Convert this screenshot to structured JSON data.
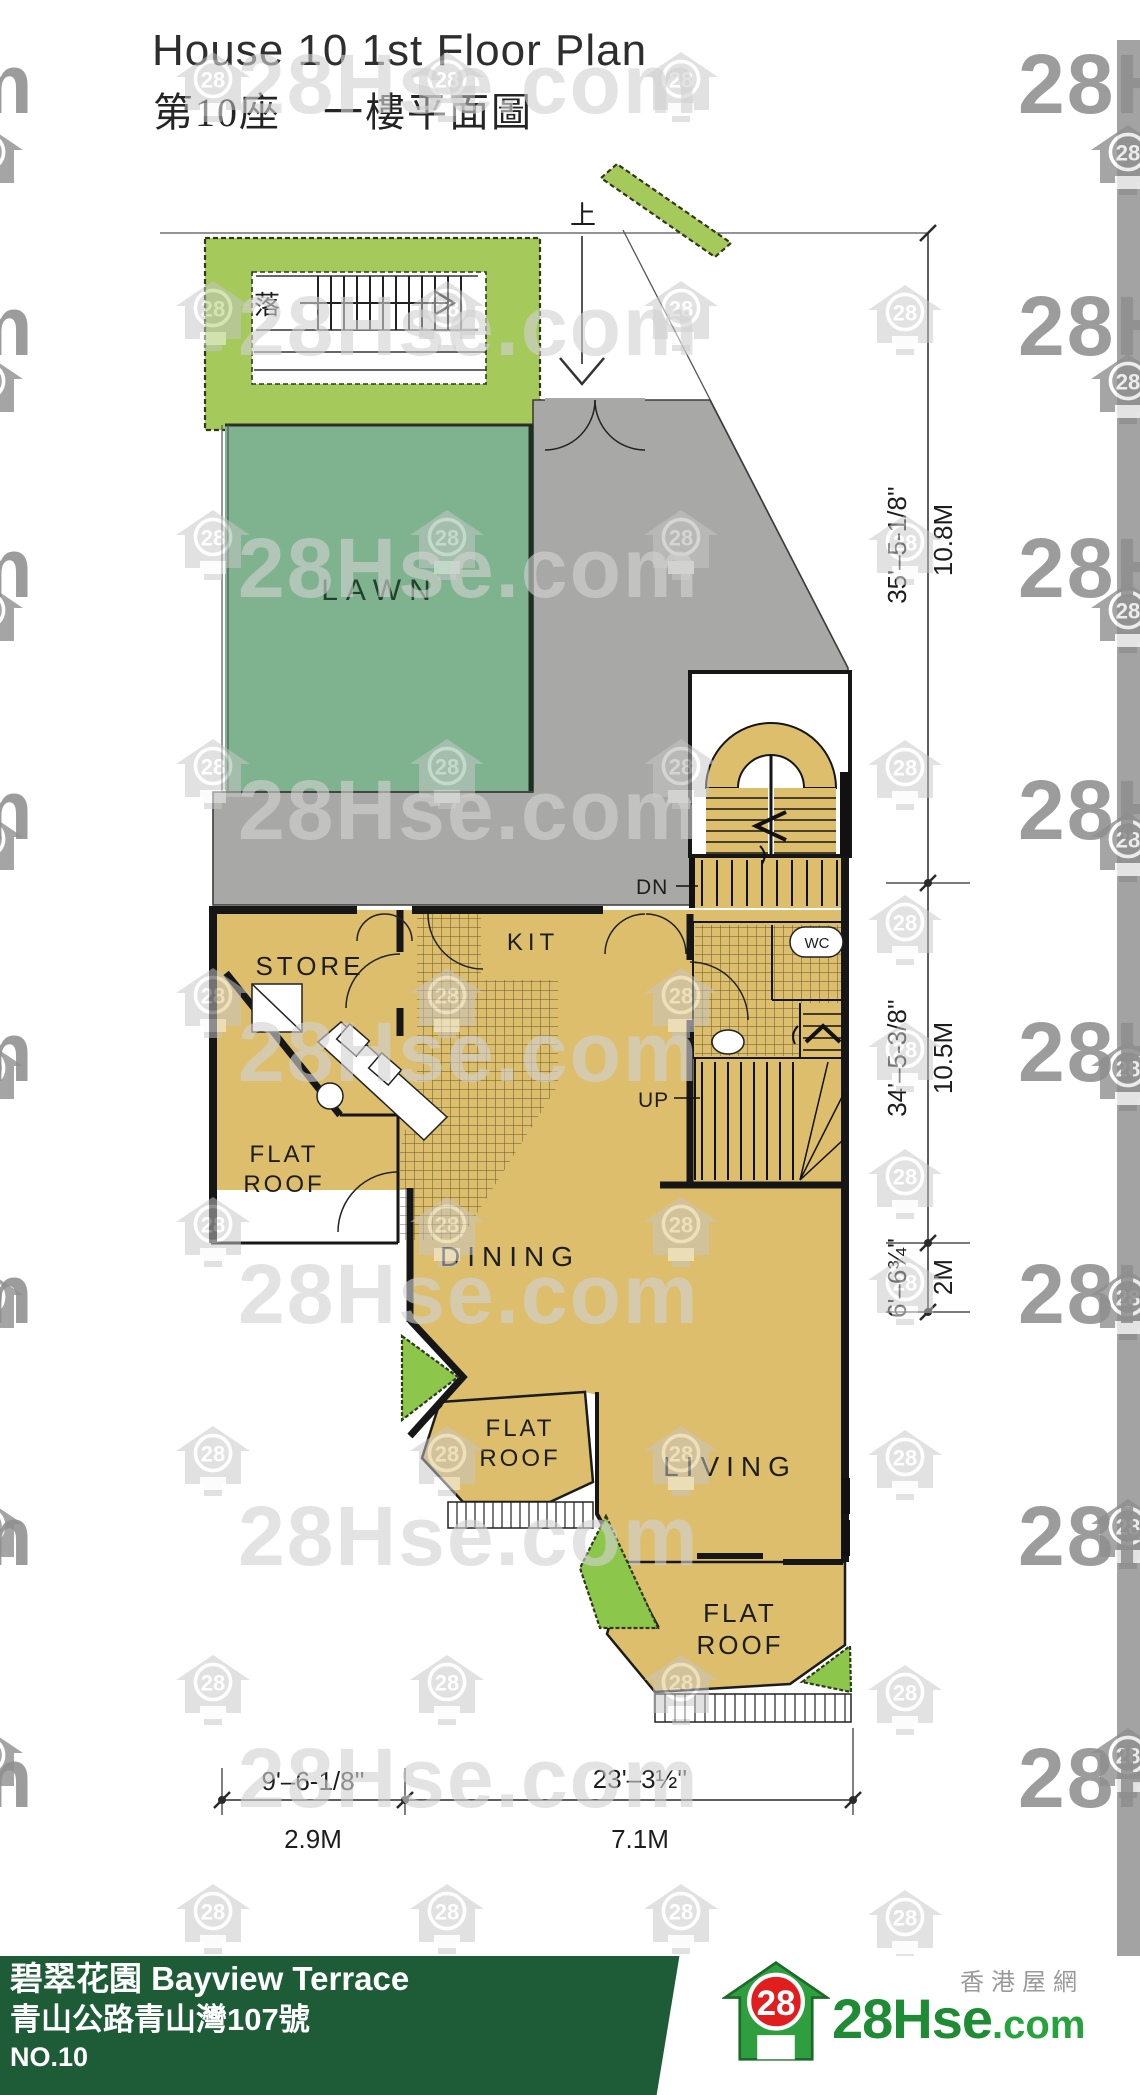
{
  "header": {
    "title_en": "House 10 1st Floor Plan",
    "title_zh": "第10座　一樓平面圖"
  },
  "plan": {
    "north_label": "上",
    "descend_label": "落",
    "rooms": {
      "lawn": "LAWN",
      "store": "STORE",
      "kitchen": "KIT",
      "wc": "WC",
      "dining": "DINING",
      "living": "LIVING",
      "flat": "FLAT",
      "roof": "ROOF"
    },
    "stairs": {
      "down": "DN",
      "up": "UP"
    },
    "dims": {
      "right": [
        {
          "ft": "35'–5-1/8''",
          "m": "10.8M"
        },
        {
          "ft": "34'–5-3/8''",
          "m": "10.5M"
        },
        {
          "ft": "6'–6¾''",
          "m": "2M"
        }
      ],
      "bottom": [
        {
          "ft": "9'–6-1/8''",
          "m": "2.9M"
        },
        {
          "ft": "23'–3½''",
          "m": "7.1M"
        }
      ]
    }
  },
  "watermark": {
    "site": "28Hse.com",
    "badge": "28",
    "fragment_right": "28Hs",
    "fragment_left": "m"
  },
  "footer": {
    "estate_zh": "碧翠花園",
    "estate_en": "Bayview Terrace",
    "address": "青山公路青山灣107號",
    "house_no": "NO.10",
    "logo_badge": "28",
    "logo_main": "28Hse",
    "logo_suffix": ".com",
    "tagline": "香港屋網"
  }
}
